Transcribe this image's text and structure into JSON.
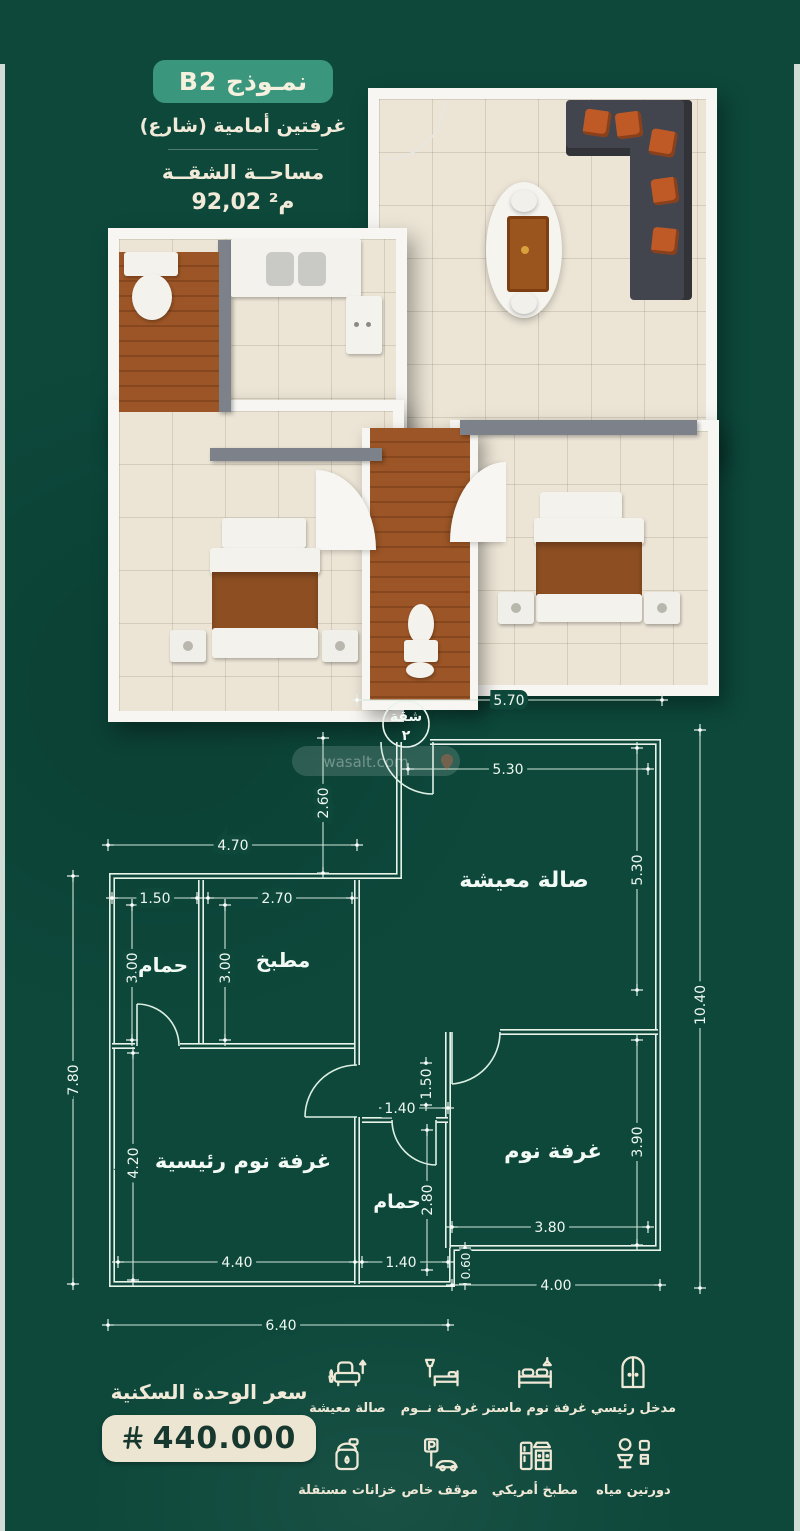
{
  "header": {
    "model_label": "نمـوذج B2",
    "subtitle": "غرفتين أمامية (شارع)",
    "area_label": "مساحــة الشقــة",
    "area_value": "92,02 م²"
  },
  "watermark": {
    "text": "wasalt.com"
  },
  "plan2d": {
    "badge": {
      "line1": "شقة",
      "line2": "٢"
    },
    "rooms": [
      "صالة معيشة",
      "مطبخ",
      "حمام",
      "غرفة نوم رئيسية",
      "حمام",
      "غرفة نوم"
    ],
    "dims": [
      "5.70",
      "2.60",
      "5.30",
      "5.30",
      "10.40",
      "4.70",
      "1.50",
      "2.70",
      "3.00",
      "3.00",
      "7.80",
      "4.20",
      "1.50",
      "1.40",
      "2.80",
      "3.90",
      "4.40",
      "1.40",
      "3.80",
      "0.60",
      "4.00",
      "6.40"
    ]
  },
  "price": {
    "label": "سعر الوحدة السكنية",
    "value": "440.000",
    "currency_icon": "saudi-riyal-symbol"
  },
  "features": [
    {
      "icon": "door-icon",
      "label": "مدخل رئيسي"
    },
    {
      "icon": "master-bed-icon",
      "label": "غرفة نوم ماستر"
    },
    {
      "icon": "bed-icon",
      "label": "غرفــة نــوم"
    },
    {
      "icon": "sofa-icon",
      "label": "صالة معيشة"
    },
    {
      "icon": "toilet-icon",
      "label": "دورتين مياه"
    },
    {
      "icon": "kitchen-icon",
      "label": "مطبخ أمريكي"
    },
    {
      "icon": "parking-icon",
      "label": "موقف خاص"
    },
    {
      "icon": "tank-icon",
      "label": "خزانات مستقلة"
    }
  ],
  "colors": {
    "background_green": "#0d483b",
    "pill_green": "#3a967d",
    "cream_text": "#f1ead9",
    "plan_line": "#d8ebdf",
    "price_pill_bg": "#ece5d2",
    "price_text": "#17382e",
    "wood": "#9b5526",
    "sofa_dark": "#42454d",
    "cushion_orange": "#bf5a26"
  }
}
